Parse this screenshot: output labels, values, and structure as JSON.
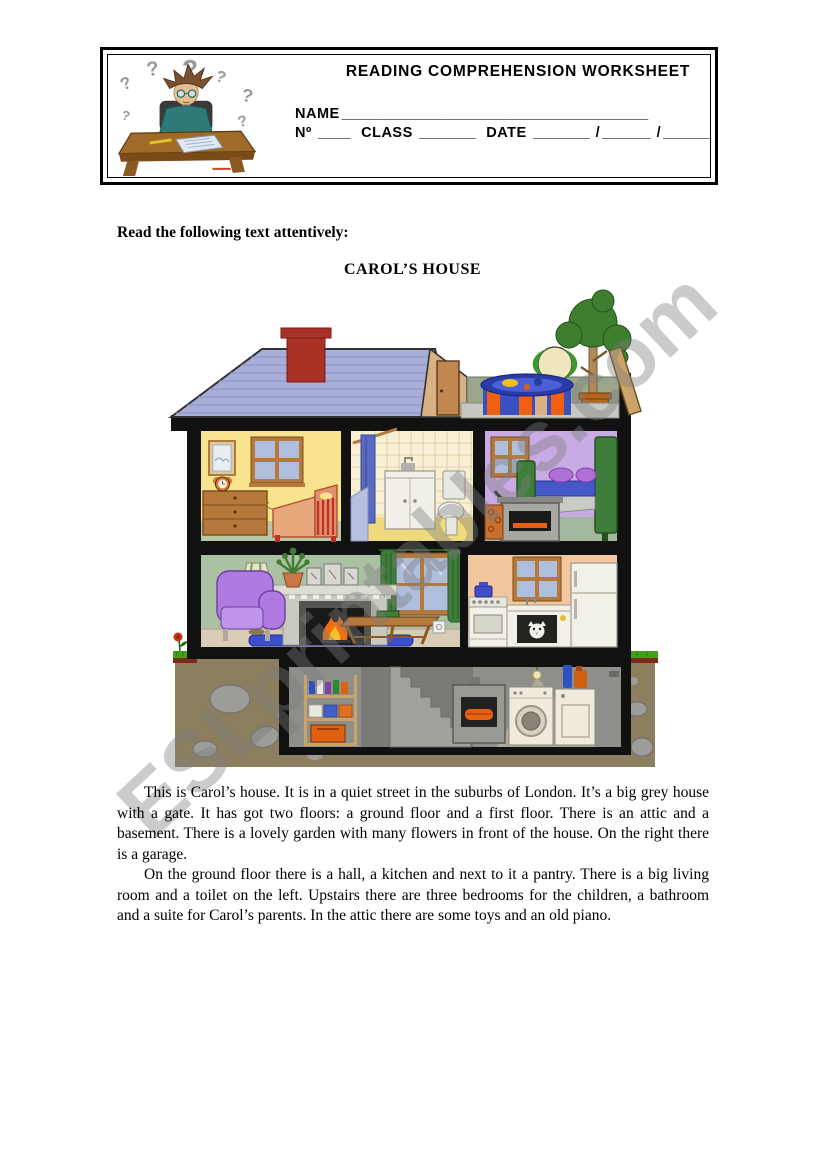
{
  "header": {
    "title": "READING COMPREHENSION WORKSHEET",
    "fields": {
      "name_label": "NAME",
      "name_blank": "______________________________________",
      "number_label": "Nº",
      "number_blank": "____",
      "class_label": "CLASS",
      "class_blank": "_______",
      "date_label": "DATE",
      "date_blank_day": "_______",
      "date_slash": "/",
      "date_blank_month": "______",
      "date_blank_year": "______"
    },
    "cartoon": {
      "name": "confused-student-at-desk",
      "question_mark": "?"
    }
  },
  "instruction": "Read the following text attentively:",
  "passage": {
    "title": "CAROL’S HOUSE",
    "paragraphs": [
      "This is  Carol’s house. It is in a quiet street in the suburbs of London. It’s a big grey house with a gate. It has got two floors: a ground floor and a first floor. There is an attic and a basement. There is a lovely garden with many flowers in front of the house. On the right there is a garage.",
      "On the ground floor there is a hall, a kitchen and next to it a pantry. There is a big living room and a toilet on the left. Upstairs there are three bedrooms for the children, a bathroom and a suite for Carol’s parents. In the attic there are some toys and an old piano."
    ]
  },
  "watermark": {
    "text": "ESLprintables.com",
    "color": "#c9c9c9"
  },
  "house_illustration": {
    "name": "carols-house-cross-section",
    "colors": {
      "roof": "#a9aed8",
      "chimney": "#a93226",
      "attic_wall": "#d8b184",
      "terrace_wall": "#9aa58c",
      "pool_blue": "#3a4fc0",
      "pool_orange": "#f06010",
      "children_bedroom_wall": "#f8e48e",
      "bathroom_wall": "#f8f0d4",
      "parents_bedroom_wall": "#c9abe3",
      "living_room_wall": "#acc0a4",
      "kitchen_wall": "#f2c69e",
      "basement_room": "#8e8e8a",
      "earth": "#8c7f5f",
      "grass": "#3fa11c",
      "structure": "#111111"
    },
    "exterior": {
      "roof": "striped pitched roof with red chimney",
      "attic": "gable with attic door",
      "roof_terrace_items": [
        "paddling-pool",
        "beach-ball",
        "potted-tree",
        "leaning-ladder"
      ],
      "garden_items": [
        "grass",
        "red-flower"
      ]
    },
    "first_floor_rooms": [
      {
        "room": "children-bedroom",
        "items": [
          "framed-picture",
          "window",
          "alarm-clock",
          "chest-of-drawers",
          "cot-bed"
        ]
      },
      {
        "room": "bathroom",
        "items": [
          "shower-rod",
          "shower-curtain",
          "bathtub",
          "washbasin-cabinet",
          "toilet"
        ]
      },
      {
        "room": "parents-bedroom",
        "items": [
          "window",
          "double-bed",
          "purple-pillows",
          "wood-stove",
          "firewood-stack"
        ]
      }
    ],
    "ground_floor_rooms": [
      {
        "room": "living-room",
        "items": [
          "armchair",
          "floor-lamp",
          "potted-plant",
          "fireplace",
          "picture-frames",
          "window-with-green-curtains",
          "coffee-table",
          "blue-rug",
          "power-outlet"
        ]
      },
      {
        "room": "kitchen",
        "items": [
          "window",
          "cooker",
          "blue-saucepan",
          "sink-counter",
          "cat-in-cupboard",
          "fridge"
        ]
      }
    ],
    "basement": {
      "items": [
        "storage-shelf",
        "toolbox",
        "staircase",
        "light-bulb",
        "furnace-with-fire",
        "washing-machine",
        "dryer",
        "detergent-bottles"
      ],
      "surround": "earth-with-rocks"
    }
  }
}
